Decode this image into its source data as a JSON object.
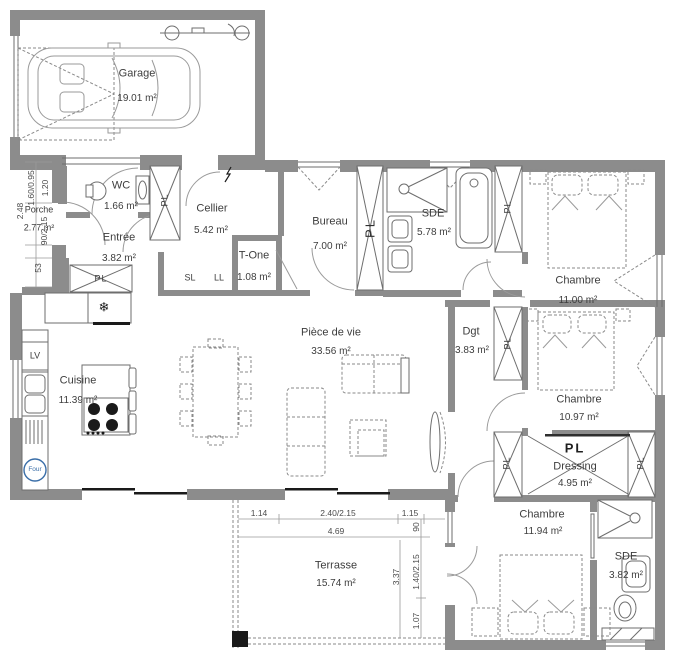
{
  "rooms": {
    "garage": {
      "name": "Garage",
      "area": "19.01 m²"
    },
    "porche": {
      "name": "Porche",
      "area": "2.77 m²"
    },
    "wc": {
      "name": "WC",
      "area": "1.66 m²"
    },
    "entree": {
      "name": "Entrée",
      "area": "3.82 m²"
    },
    "cellier": {
      "name": "Cellier",
      "area": "5.42 m²"
    },
    "tone": {
      "name": "T-One",
      "area": "1.08 m²"
    },
    "bureau": {
      "name": "Bureau",
      "area": "7.00 m²"
    },
    "sde1": {
      "name": "SDE",
      "area": "5.78 m²"
    },
    "chambre1": {
      "name": "Chambre",
      "area": "11.00 m²"
    },
    "piece": {
      "name": "Pièce de vie",
      "area": "33.56 m²"
    },
    "dgt": {
      "name": "Dgt",
      "area": "3.83 m²"
    },
    "cuisine": {
      "name": "Cuisine",
      "area": "11.39 m²"
    },
    "chambre2": {
      "name": "Chambre",
      "area": "10.97 m²"
    },
    "dressing": {
      "name": "Dressing",
      "area": "4.95 m²"
    },
    "chambre3": {
      "name": "Chambre",
      "area": "11.94 m²"
    },
    "sde2": {
      "name": "SDE",
      "area": "3.82 m²"
    },
    "terrasse": {
      "name": "Terrasse",
      "area": "15.74 m²"
    }
  },
  "labels": {
    "pl": "PL",
    "sl": "SL",
    "ll": "LL",
    "lv": "LV",
    "four": "Four"
  },
  "icons": {
    "freezer": "❄"
  },
  "dimensions": {
    "porch_win": "1.60/0.95",
    "porch_w": "1.20",
    "porch_h": "2.48",
    "porch_door": "90/2.15",
    "porch_s": "53",
    "ter_a": "1.14",
    "ter_b": "2.40/2.15",
    "ter_c": "1.15",
    "ter_total": "4.69",
    "ter_90": "90",
    "ter_h": "3.37",
    "ter_win": "1.40/2.15",
    "ter_e": "1.07"
  },
  "colors": {
    "wall": "#8c8c8c",
    "accent_blue": "#3a6ea8"
  }
}
